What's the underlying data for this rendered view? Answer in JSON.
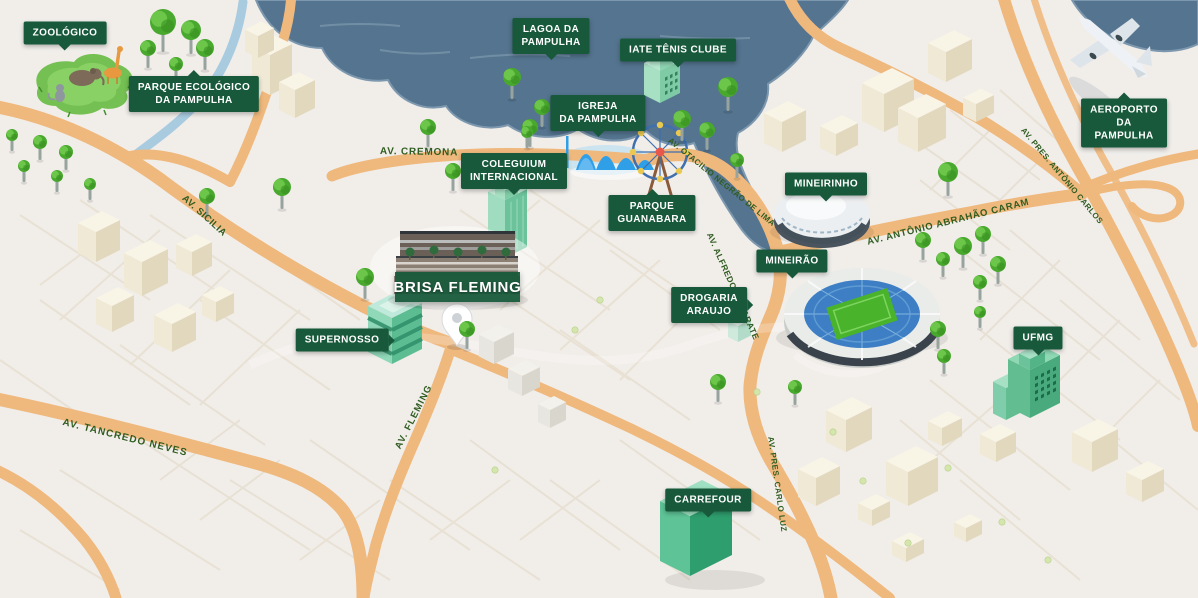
{
  "project": {
    "name": "BRISA FLEMING"
  },
  "landmarks": [
    {
      "id": "zoologico",
      "label": "ZOOLÓGICO"
    },
    {
      "id": "parque-ecologico",
      "label": "PARQUE ECOLÓGICO\nDA PAMPULHA"
    },
    {
      "id": "lagoa-da-pampulha",
      "label": "LAGOA DA\nPAMPULHA"
    },
    {
      "id": "iate-tenis-clube",
      "label": "IATE TÊNIS CLUBE"
    },
    {
      "id": "igreja-da-pampulha",
      "label": "IGREJA\nDA PAMPULHA"
    },
    {
      "id": "aeroporto-da-pampulha",
      "label": "AEROPORTO\nDA PAMPULHA"
    },
    {
      "id": "coleguium-internacional",
      "label": "COLEGUIUM\nINTERNACIONAL"
    },
    {
      "id": "parque-guanabara",
      "label": "PARQUE\nGUANABARA"
    },
    {
      "id": "mineirinho",
      "label": "MINEIRINHO"
    },
    {
      "id": "mineirao",
      "label": "MINEIRÃO"
    },
    {
      "id": "supernosso",
      "label": "SUPERNOSSO"
    },
    {
      "id": "drogaria-araujo",
      "label": "DROGARIA\nARAUJO"
    },
    {
      "id": "ufmg",
      "label": "UFMG"
    },
    {
      "id": "carrefour",
      "label": "CARREFOUR"
    }
  ],
  "roads": [
    {
      "id": "av-cremona",
      "label": "AV. CREMONA"
    },
    {
      "id": "av-sicilia",
      "label": "AV. SICILIA"
    },
    {
      "id": "av-tancredo-neves",
      "label": "AV. TANCREDO NEVES"
    },
    {
      "id": "av-fleming",
      "label": "AV. FLEMING"
    },
    {
      "id": "av-otacilio-negrao-de-lima",
      "label": "AV. OTACILIO NEGRÃO DE LIMA"
    },
    {
      "id": "av-alfredo-camarate",
      "label": "AV. ALFREDO CAMARATE"
    },
    {
      "id": "av-antonio-abrahao-caram",
      "label": "AV. ANTÔNIO ABRAHÃO CARAM"
    },
    {
      "id": "av-pres-antonio-carlos",
      "label": "AV. PRES. ANTÔNIO CARLOS"
    },
    {
      "id": "av-pres-carlo-luz",
      "label": "AV. PRES. CARLO LUZ"
    }
  ],
  "colors": {
    "label_bg": "#17593a",
    "label_text": "#ffffff",
    "road": "#efb87d",
    "road_text": "#2f5c20",
    "water": "#54748f",
    "river": "#a9cbe0",
    "tree": "#49a82e",
    "landmark_building": "#58bd8f",
    "background": "#f1eeea"
  }
}
